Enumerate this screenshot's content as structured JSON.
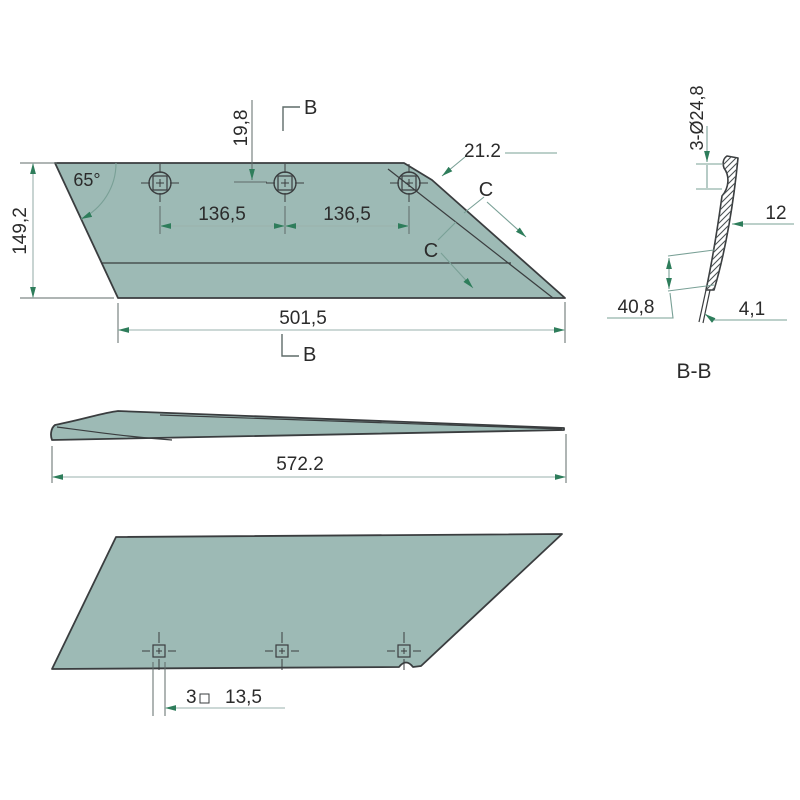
{
  "main_view": {
    "height": "149,2",
    "angle": "65°",
    "hole_offset_top": "19,8",
    "hole_spacing_left": "136,5",
    "hole_spacing_right": "136,5",
    "bevel_width": "21.2",
    "bottom_width": "501,5",
    "section_marker_b_top": "B",
    "section_marker_b_bottom": "B",
    "section_marker_c_upper": "C",
    "section_marker_c_lower": "C"
  },
  "side_view": {
    "length": "572.2"
  },
  "bottom_view": {
    "hole_count": "3",
    "hole_square_size": "13,5"
  },
  "section_view": {
    "title": "B-B",
    "hole_spec": "3-Ø24,8",
    "thickness": "12",
    "bevel_length": "40,8",
    "edge_thickness": "4,1"
  },
  "colors": {
    "blade_fill": "#9dbab5",
    "outline": "#3a3d3f",
    "dim_line": "#9ab1ac",
    "ext_line": "#5f6b69",
    "leader": "#79a096",
    "arrow": "#2e7d5b",
    "text": "#2b2b2b",
    "hatch": "#4b5254"
  }
}
